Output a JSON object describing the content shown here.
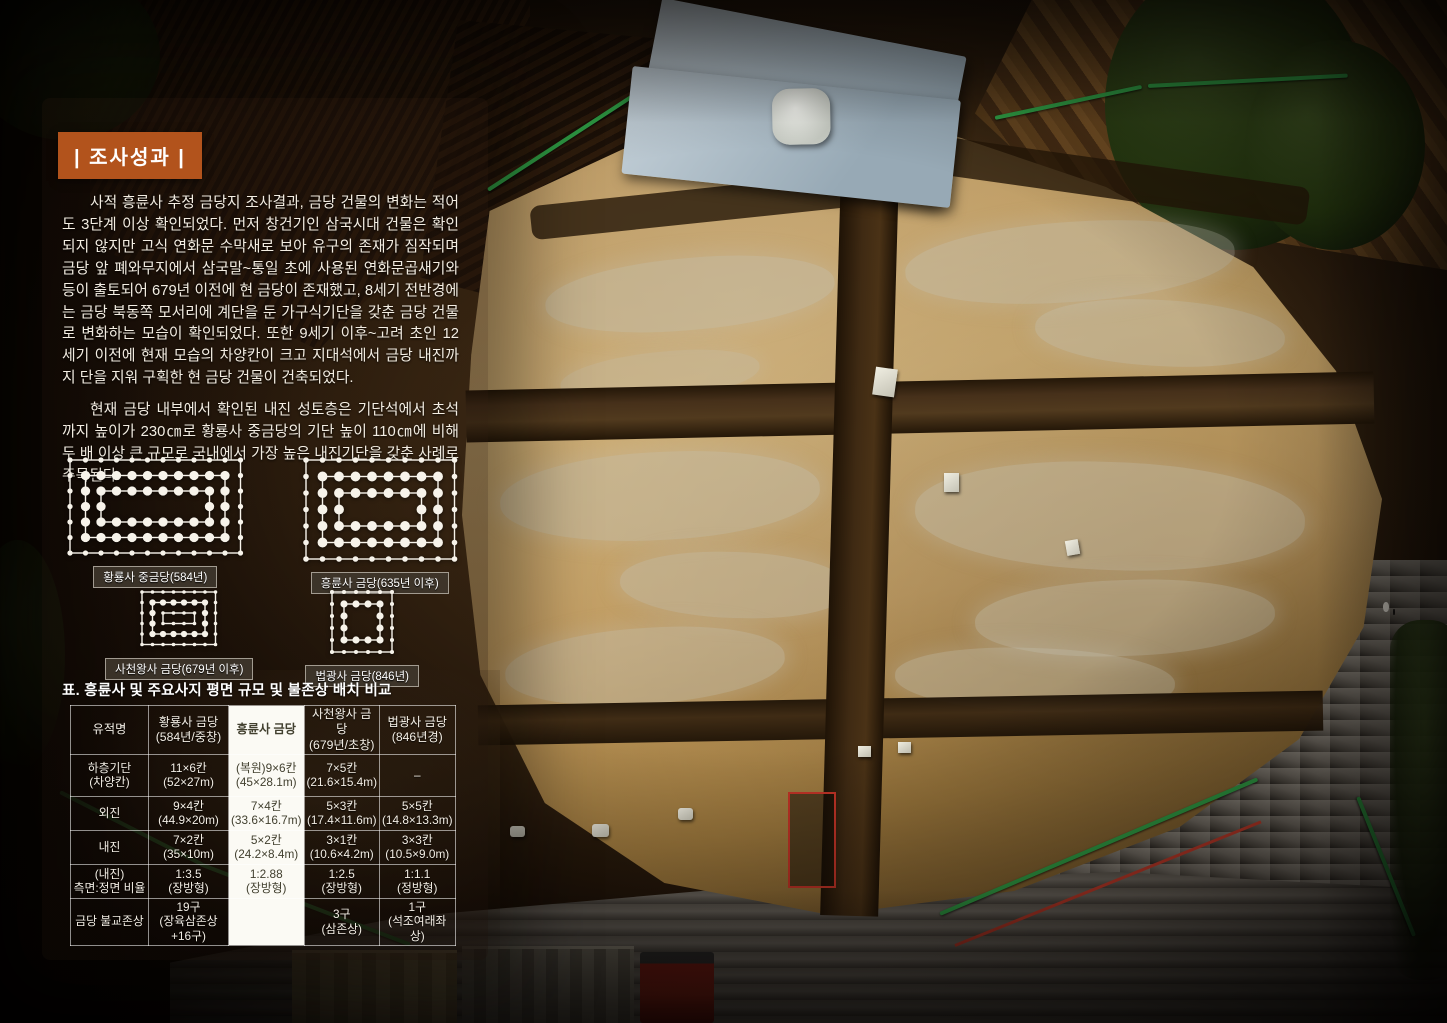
{
  "colors": {
    "accent_orange": "#b2531c",
    "fence_green": "#2f9e45",
    "highlight_bg": "#fbfaf4",
    "dot_white": "#f7f3ea"
  },
  "title": "| 조사성과 |",
  "paragraphs": [
    "사적 흥륜사 추정 금당지 조사결과, 금당 건물의 변화는 적어도 3단계 이상 확인되었다. 먼저 창건기인 삼국시대 건물은 확인되지 않지만 고식 연화문 수막새로 보아 유구의 존재가 짐작되며 금당 앞 폐와무지에서 삼국말~통일 초에 사용된 연화문곱새기와 등이 출토되어 679년 이전에 현 금당이 존재했고, 8세기 전반경에는 금당 북동쪽 모서리에 계단을 둔 가구식기단을 갖춘 금당 건물로 변화하는 모습이 확인되었다. 또한 9세기 이후~고려 초인 12세기 이전에 현재 모습의 차양칸이 크고 지대석에서 금당 내진까지 단을 지워 구획한 현 금당 건물이 건축되었다.",
    "현재 금당 내부에서 확인된 내진 성토층은 기단석에서 초석까지 높이가 230㎝로 황룡사 중금당의 기단 높이 110㎝에 비해 두 배 이상 큰 규모로 국내에서 가장 높은 내진기단을 갖춘 사례로 주목된다."
  ],
  "diagrams": [
    {
      "label": "황룡사 중금당(584년)",
      "rings": [
        {
          "cols": 12,
          "rows": 7,
          "dot": "small"
        },
        {
          "cols": 10,
          "rows": 5,
          "dot": "large"
        },
        {
          "cols": 8,
          "rows": 3,
          "dot": "large"
        }
      ]
    },
    {
      "label": "흥륜사 금당(635년 이후)",
      "rings": [
        {
          "cols": 10,
          "rows": 7,
          "dot": "small"
        },
        {
          "cols": 8,
          "rows": 5,
          "dot": "large"
        },
        {
          "cols": 6,
          "rows": 3,
          "dot": "large"
        }
      ]
    },
    {
      "label": "사천왕사 금당(679년 이후)",
      "rings": [
        {
          "cols": 8,
          "rows": 6,
          "dot": "small"
        },
        {
          "cols": 6,
          "rows": 4,
          "dot": "large"
        },
        {
          "cols": 4,
          "rows": 2,
          "dot": "small"
        }
      ]
    },
    {
      "label": "법광사 금당(846년)",
      "rings": [
        {
          "cols": 6,
          "rows": 6,
          "dot": "small"
        },
        {
          "cols": 4,
          "rows": 4,
          "dot": "large"
        }
      ]
    }
  ],
  "table": {
    "caption": "표. 흥륜사 및 주요사지 평면 규모 및 불존상 배치 비교",
    "col_headers": [
      [
        "유적명"
      ],
      [
        "황룡사 금당",
        "(584년/중창)"
      ],
      [
        "흥륜사 금당"
      ],
      [
        "사천왕사 금당",
        "(679년/초창)"
      ],
      [
        "법광사 금당",
        "(846년경)"
      ]
    ],
    "highlight_col": 2,
    "rows": [
      {
        "label": [
          "하층기단",
          "(차양칸)"
        ],
        "cells": [
          [
            "11×6칸",
            "(52×27m)"
          ],
          [
            "(복원)9×6칸",
            "(45×28.1m)"
          ],
          [
            "7×5칸",
            "(21.6×15.4m)"
          ],
          [
            "–"
          ]
        ]
      },
      {
        "label": [
          "외진"
        ],
        "cells": [
          [
            "9×4칸",
            "(44.9×20m)"
          ],
          [
            "7×4칸",
            "(33.6×16.7m)"
          ],
          [
            "5×3칸",
            "(17.4×11.6m)"
          ],
          [
            "5×5칸",
            "(14.8×13.3m)"
          ]
        ]
      },
      {
        "label": [
          "내진"
        ],
        "cells": [
          [
            "7×2칸",
            "(35×10m)"
          ],
          [
            "5×2칸",
            "(24.2×8.4m)"
          ],
          [
            "3×1칸",
            "(10.6×4.2m)"
          ],
          [
            "3×3칸",
            "(10.5×9.0m)"
          ]
        ]
      },
      {
        "label": [
          "(내진)",
          "측면:정면 비율"
        ],
        "cells": [
          [
            "1:3.5",
            "(장방형)"
          ],
          [
            "1:2.88",
            "(장방형)"
          ],
          [
            "1:2.5",
            "(장방형)"
          ],
          [
            "1:1.1",
            "(정방형)"
          ]
        ]
      },
      {
        "label": [
          "금당 불교존상"
        ],
        "cells": [
          [
            "19구",
            "(장육삼존상+16구)"
          ],
          [],
          [
            "3구",
            "(삼존상)"
          ],
          [
            "1구",
            "(석조여래좌상)"
          ]
        ]
      }
    ]
  }
}
